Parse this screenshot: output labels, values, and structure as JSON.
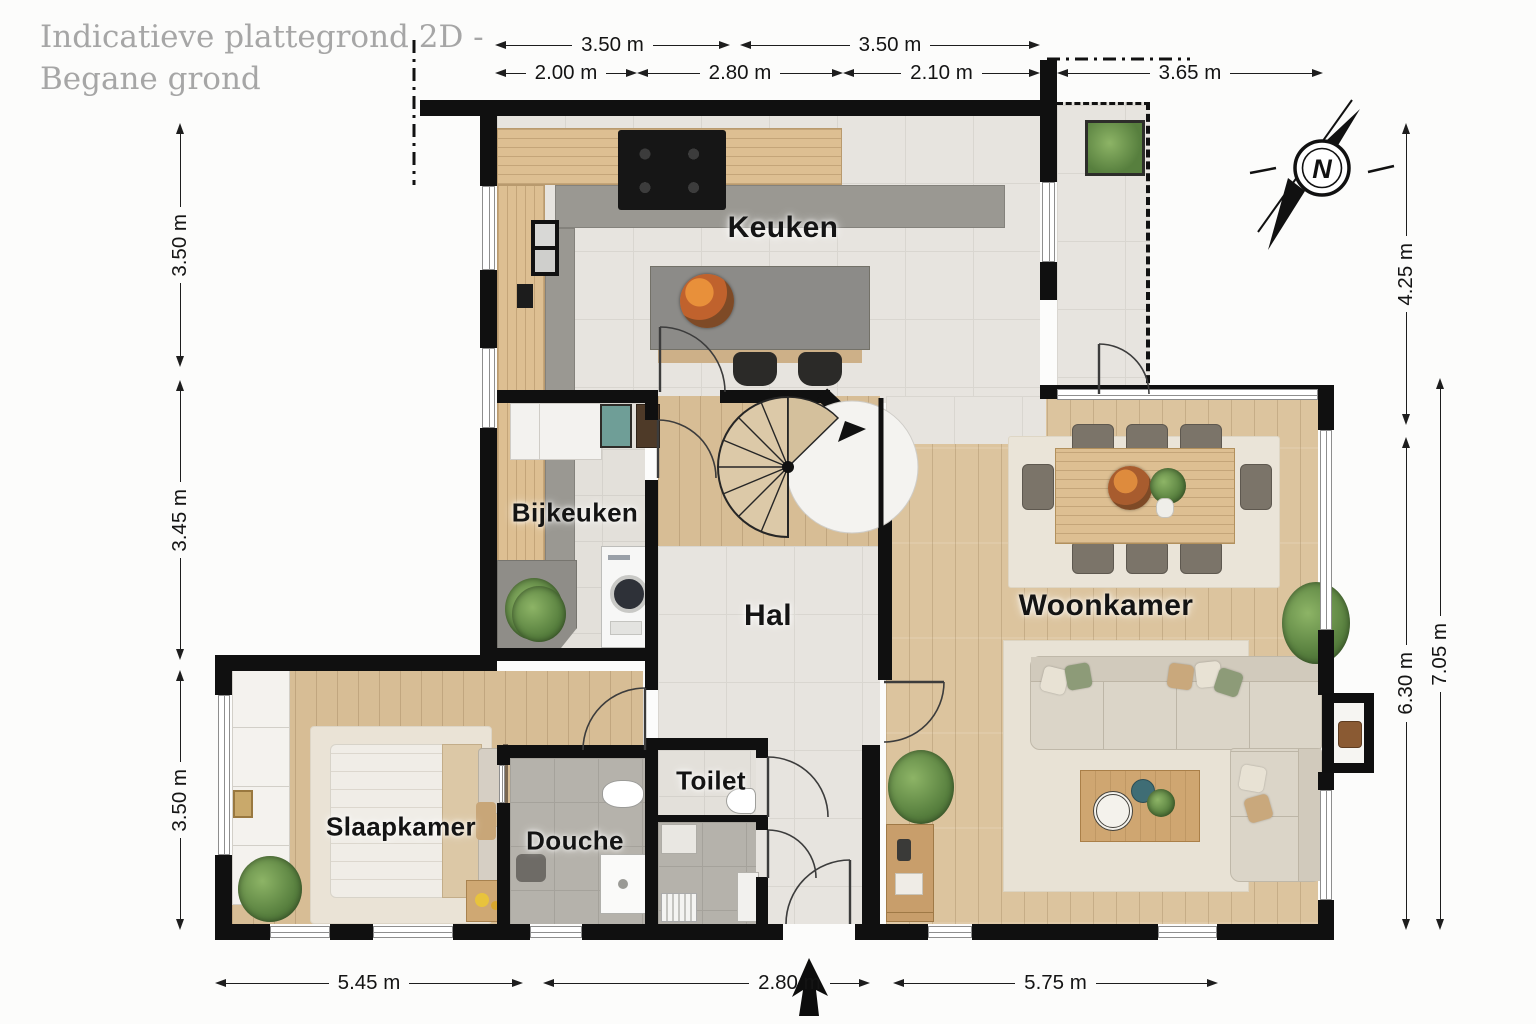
{
  "title": {
    "line1": "Indicatieve plattegrond 2D -",
    "line2": "Begane grond"
  },
  "compass": {
    "label": "N"
  },
  "rooms": {
    "keuken": "Keuken",
    "bijkeuken": "Bijkeuken",
    "hal": "Hal",
    "woonkamer": "Woonkamer",
    "slaapkamer": "Slaapkamer",
    "douche": "Douche",
    "toilet": "Toilet"
  },
  "dimensions": {
    "top_row1": [
      "3.50 m",
      "3.50 m"
    ],
    "top_row2": [
      "2.00 m",
      "2.80 m",
      "2.10 m",
      "3.65 m"
    ],
    "left": [
      "3.50 m",
      "3.45 m",
      "3.50 m"
    ],
    "right": [
      "4.25 m",
      "6.30 m",
      "7.05 m"
    ],
    "bottom": [
      "5.45 m",
      "2.80 m",
      "5.75 m"
    ]
  },
  "colors": {
    "wall": "#101010",
    "wood_floor": "#dcc49e",
    "tile_floor": "#e7e4df",
    "counter_gray": "#9a9892",
    "plant_green": "#577f3e"
  }
}
